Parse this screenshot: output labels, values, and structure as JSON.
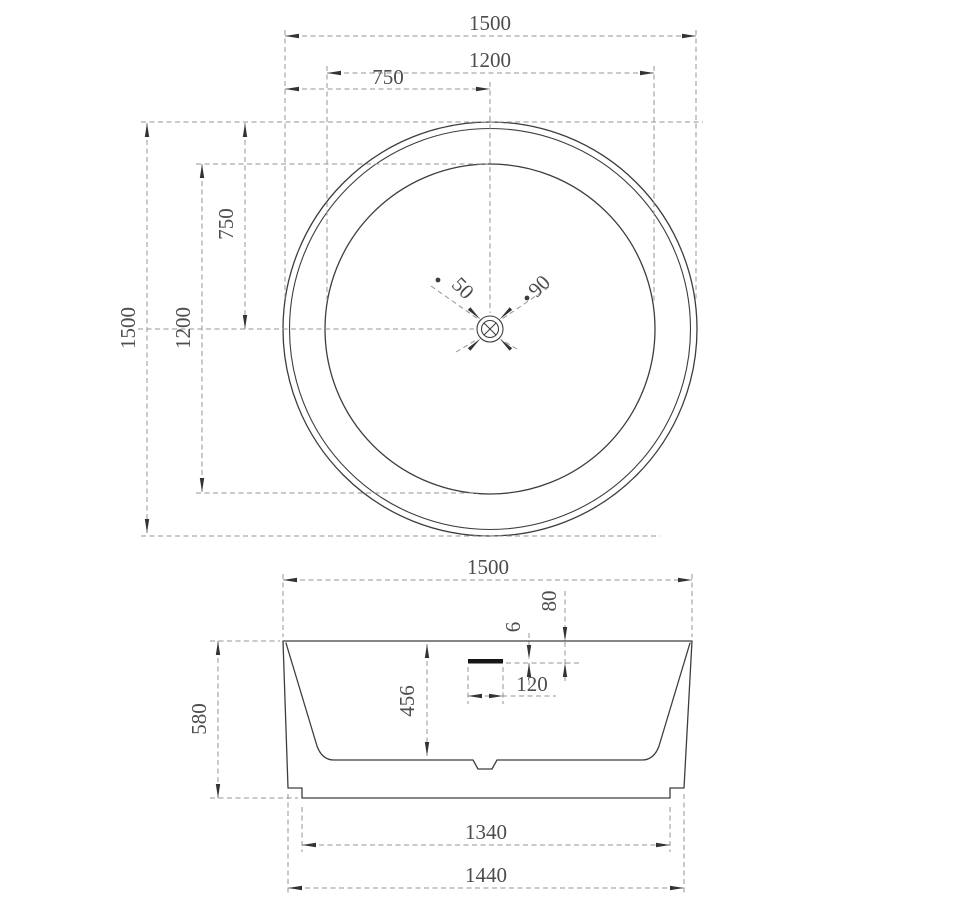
{
  "drawing": {
    "type": "technical-drawing",
    "subject": "round freestanding bathtub, plan and elevation views",
    "views": {
      "top": {
        "dims": {
          "overall_width": "1500",
          "basin_width": "1200",
          "center_offset_h": "750",
          "overall_height": "1500",
          "basin_height": "1200",
          "center_offset_v": "750",
          "drain_dia_small": "50",
          "drain_dia_large": "90"
        }
      },
      "side": {
        "dims": {
          "overall_width": "1500",
          "overall_height": "580",
          "inner_depth": "456",
          "overflow_offset_top": "80",
          "overflow_slot_height": "6",
          "overflow_slot_width": "120",
          "base_width": "1340",
          "foot_width": "1440"
        }
      }
    },
    "colors": {
      "background": "#ffffff",
      "outline": "#3d3d3d",
      "dim_line": "#949494",
      "text": "#4d4d4d"
    }
  }
}
